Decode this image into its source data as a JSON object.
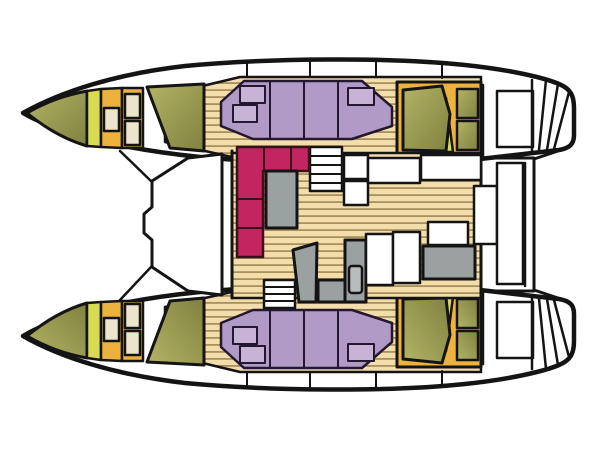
{
  "meta": {
    "title": "Catamaran deck and cabin floor plan",
    "view": "top-down",
    "orientation": "bow-left",
    "diagram_type": "boat-layout"
  },
  "colors": {
    "outline": "#141414",
    "hull_white": "#ffffff",
    "wood_base": "#f2ddab",
    "wood_line": "#a8915e",
    "olive": "#b3b465",
    "olive_dark": "#7f8140",
    "yellow_green": "#d8da52",
    "orange": "#edb13e",
    "cream": "#ece4cd",
    "purple": "#b29ac6",
    "purple_light": "#c6b3d6",
    "magenta": "#c32561",
    "gray": "#9ba0a1",
    "gray_light": "#b8bcbc"
  },
  "parts": [
    "starboard-hull",
    "port-hull",
    "bow-v-berth",
    "bow-deck-hatches",
    "forward-cabin-bed",
    "hull-settee",
    "settee-pillows",
    "aft-cabin-bed",
    "bed-frame-hatches",
    "heads-compartment",
    "transom-steps",
    "foredeck-locker-panel",
    "salon-sofa",
    "salon-table",
    "companionway-stairs",
    "galley-counter",
    "galley-sink",
    "cockpit-bench",
    "cockpit-table",
    "cockpit-module",
    "wood-floor"
  ]
}
